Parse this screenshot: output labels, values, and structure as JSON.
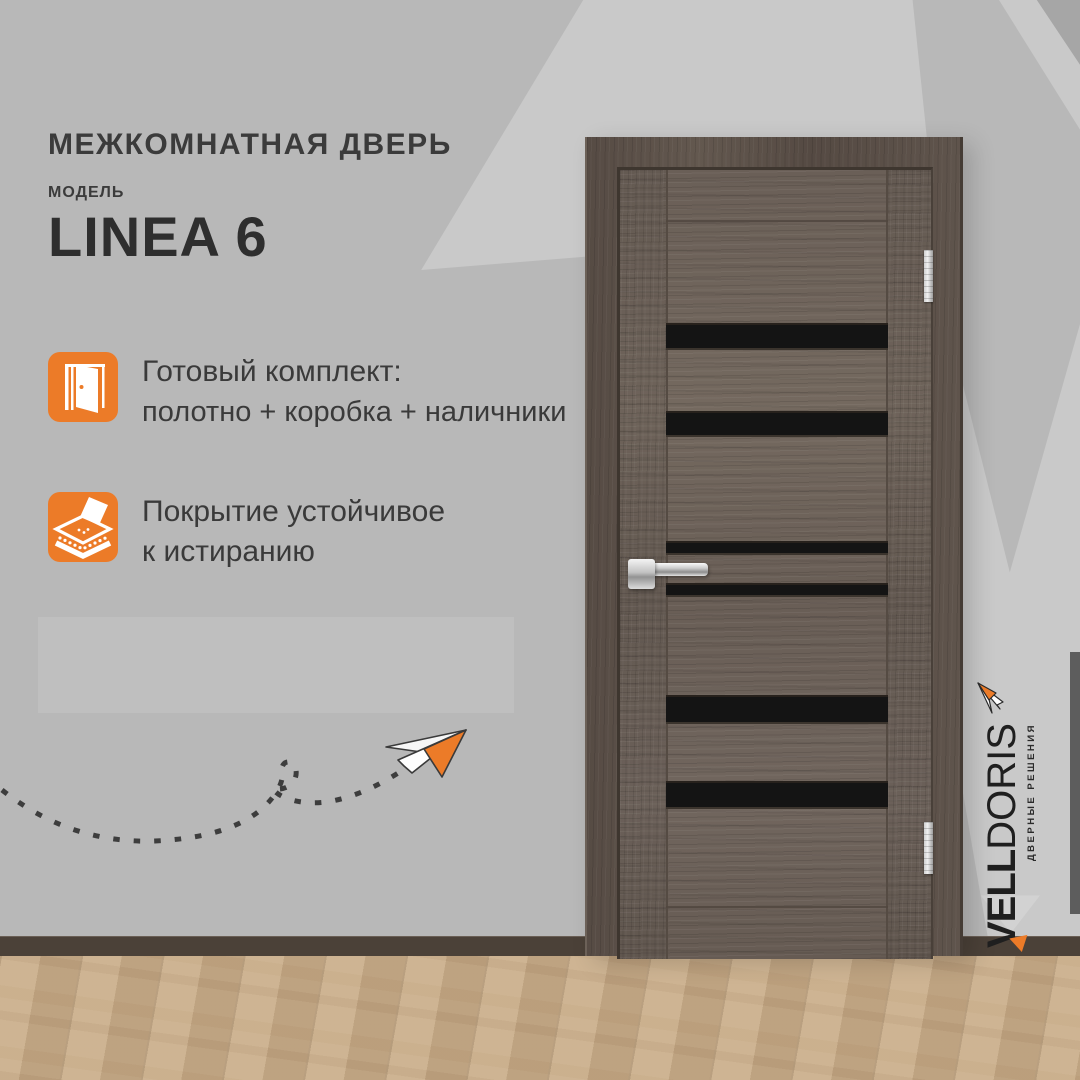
{
  "header": {
    "title": "МЕЖКОМНАТНАЯ ДВЕРЬ",
    "model_label": "МОДЕЛЬ",
    "model_name": "LINEA 6"
  },
  "features": [
    {
      "icon": "open-door-icon",
      "line1": "Готовый комплект:",
      "line2": "полотно + коробка + наличники"
    },
    {
      "icon": "abrasion-resistant-coating-icon",
      "line1": "Покрытие устойчивое",
      "line2": "к истиранию"
    }
  ],
  "brand": {
    "name_bold": "VELL",
    "name_light": "DORIS",
    "tagline": "ДВЕРНЫЕ РЕШЕНИЯ"
  },
  "colors": {
    "accent_orange": "#ec7b28",
    "wall_base": "#b8b8b8",
    "wall_light": "#c9c9c9",
    "text_dark": "#3b3b3b",
    "door_wood": "#6f645c",
    "glass_insert": "#141414",
    "baseboard": "#4b4138",
    "floor": "#c6ab89",
    "hardware_chrome": "#d9d9d9"
  },
  "door": {
    "glass_strip_count": 6,
    "hinge_count": 2,
    "handle": "chrome lever"
  }
}
